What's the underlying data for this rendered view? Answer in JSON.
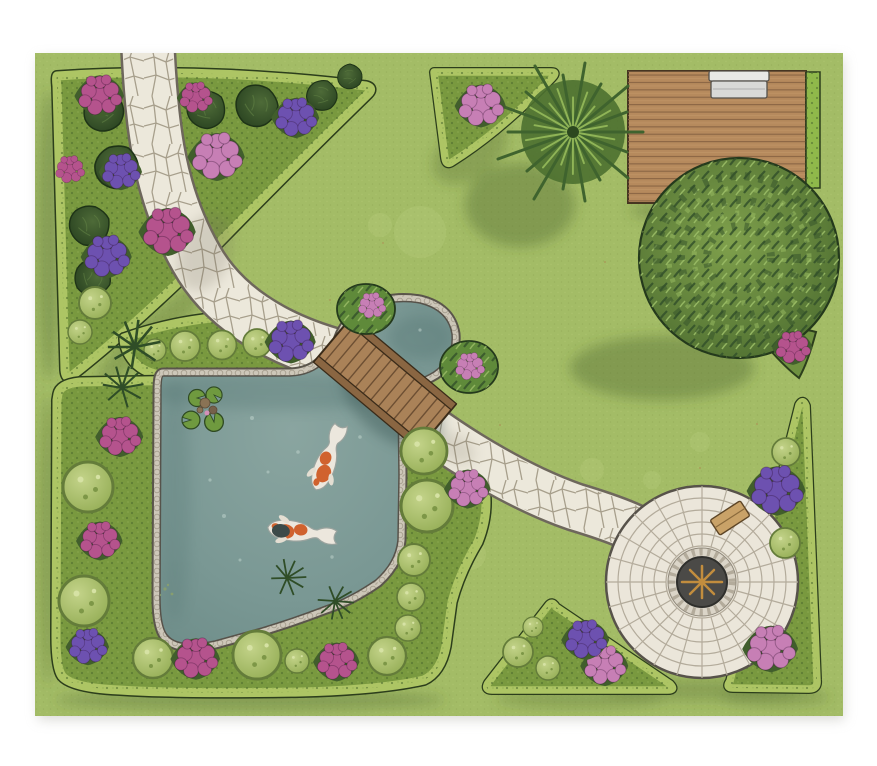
{
  "meta": {
    "description": "Top-down illustrated landscape plan of a backyard garden with koi pond, stone walkway, wooden bridge, deck and circular patio",
    "canvas_width": 877,
    "canvas_height": 766,
    "visible_text": "none"
  },
  "colors": {
    "frame": "#ffffff",
    "lawn": "#a3bc66",
    "lawn_shade": "#4f6831",
    "bed": "#79993f",
    "hedge": "#adc564",
    "hedge_outline": "#2c3e1c",
    "path_stone": "#ece8db",
    "path_outline": "#6e675c",
    "stone_edge": "#cdc7b9",
    "water_center": "#8aa5a0",
    "water_edge": "#6d8c88",
    "bridge_wood": "#aa8258",
    "bridge_rail": "#8a6642",
    "deck_wood": "#b68a5d",
    "deck_plank_line": "#8a6544",
    "patio_stone": "#ebe6da",
    "patio_joint": "#b3ab9b",
    "patio_center": "#4b4a47",
    "star_gold": "#c28d3e",
    "bench_wood": "#c9a268",
    "bench_metal": "#d9d9d7",
    "conifer_dark": "#27401f",
    "conifer_light": "#4e6b38",
    "shrub_light": "#c3d389",
    "shrub_mid": "#94ad55",
    "bush_light": "#7fa04c",
    "bush_dark": "#46662c",
    "fern_green": "#4c7030",
    "flower_magenta": "#b5538d",
    "flower_pink": "#c77fb5",
    "flower_purple": "#6d51b0",
    "koi_white": "#ece7dd",
    "koi_orange": "#d0622e",
    "koi_dark": "#3c4a49",
    "lily_pad": "#6f9a3f"
  },
  "scene": {
    "type": "garden-landscape-plan-illustration",
    "view": "top-down",
    "features": [
      {
        "name": "lawn",
        "desc": "green lawn filling the plan inside a white margin"
      },
      {
        "name": "flower-bed-top-left",
        "shape": "triangular",
        "plants": "8 dark conifer shrubs, magenta, pink and purple hydrangea clusters inside a clipped hedge border"
      },
      {
        "name": "stone-walkway",
        "desc": "flagstone path entering at the top edge, curving through the top-left bed, crossing a wooden bridge and continuing to the circular patio"
      },
      {
        "name": "koi-pond",
        "desc": "irregular pond with grey stone edging, 4 lily pads, 2 koi fish, round lobe north-east of the bridge"
      },
      {
        "name": "wooden-bridge",
        "desc": "plank footbridge with side rails crossing the pond channel diagonally"
      },
      {
        "name": "pond-border-bed",
        "desc": "L-shaped planting bed around the pond with round clipped shrubs, ornamental grasses and hydrangeas"
      },
      {
        "name": "wood-deck",
        "desc": "rectangular plank deck in the top-right corner with a metal bench and a hedge strip on its right"
      },
      {
        "name": "fern-tree",
        "desc": "large arching fern overhanging the deck's left edge"
      },
      {
        "name": "large-round-shrub",
        "desc": "big spiky-textured round shrub overlapping the deck's lower edge"
      },
      {
        "name": "stone-patio",
        "desc": "circular paver patio with concentric rings, dark centre medallion with a gold compass star and a wooden bench"
      },
      {
        "name": "flower-bed-top-center",
        "shape": "triangular",
        "plants": "pink hydrangeas"
      },
      {
        "name": "flower-bed-bottom-center",
        "shape": "triangular",
        "plants": "round shrubs, purple and pink hydrangeas"
      },
      {
        "name": "flower-bed-right",
        "shape": "triangular",
        "plants": "round shrubs, purple hydrangeas above, pink hydrangeas below"
      }
    ],
    "counts": {
      "koi_fish": 2,
      "lily_pads": 4,
      "benches": 2,
      "bridges": 1,
      "conifer_shrubs": 8,
      "flower_clusters": 23
    }
  }
}
